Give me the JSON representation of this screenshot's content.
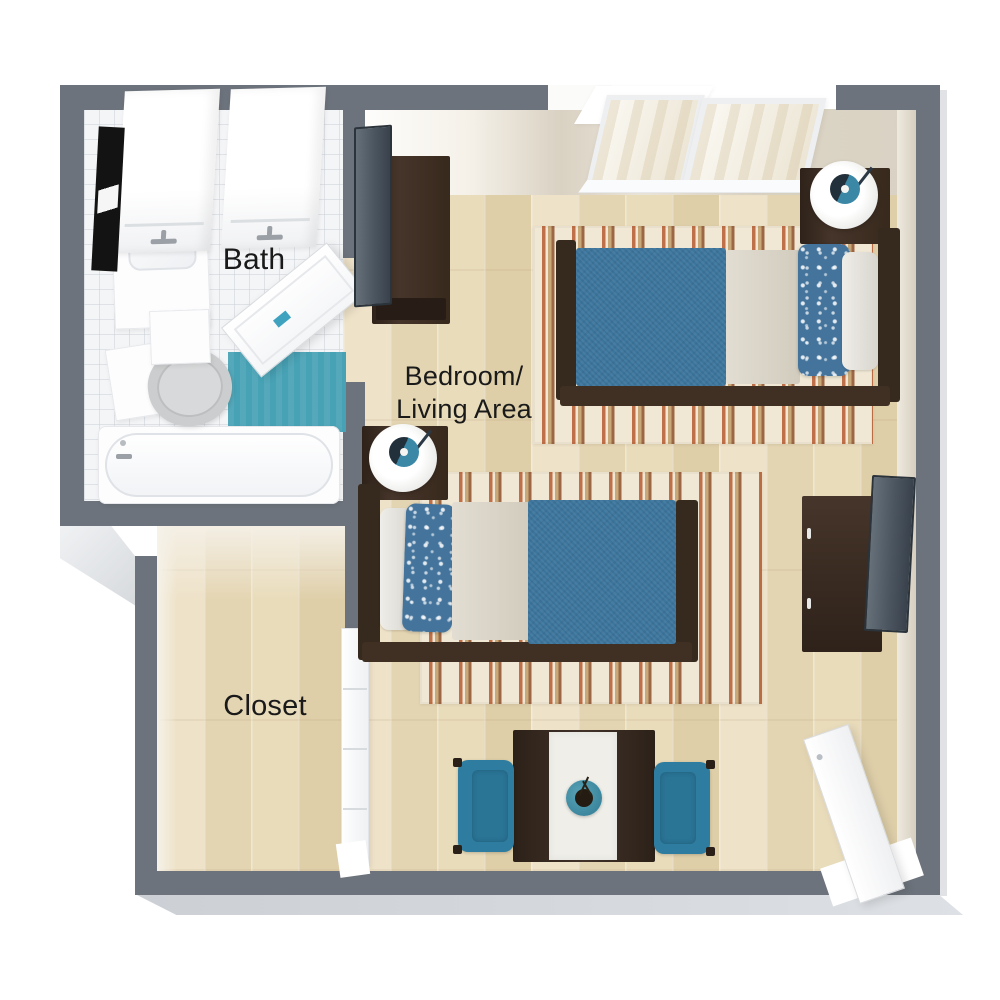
{
  "plan": {
    "type": "3d-floor-plan-top-view",
    "rooms": {
      "bath": {
        "label": "Bath",
        "fixtures": [
          "mirror",
          "vanity-sink",
          "storage-cabinet",
          "storage-cabinet",
          "toilet",
          "bathtub",
          "teal-bath-mat",
          "swing-door"
        ]
      },
      "closet": {
        "label": "Closet",
        "fixtures": [
          "bifold-doors"
        ]
      },
      "bedroom_living": {
        "label_line1": "Bedroom/",
        "label_line2": "Living Area",
        "furnishings": [
          "sliding-windows",
          "twin-bed",
          "twin-bed",
          "nightstand-with-lamp",
          "nightstand-with-lamp",
          "dresser-with-tv",
          "dresser-with-tv",
          "striped-area-rug",
          "striped-area-rug",
          "dining-table",
          "table-runner",
          "potted-plant",
          "armchair",
          "armchair",
          "entry-door"
        ]
      }
    },
    "colors": {
      "wall": "#6d737c",
      "bevel": "#d6d8dc",
      "teal": "#47a2b5",
      "bed_blue": "#3c759c",
      "chair_blue": "#2e7da0",
      "wood_dark": "#38291d",
      "tv_slate": "#4b5560",
      "rug_cream": "#f0e8d4",
      "rug_rust": "#c07048",
      "rug_tan": "#c8a878",
      "ink": "#1a1a1a"
    }
  }
}
